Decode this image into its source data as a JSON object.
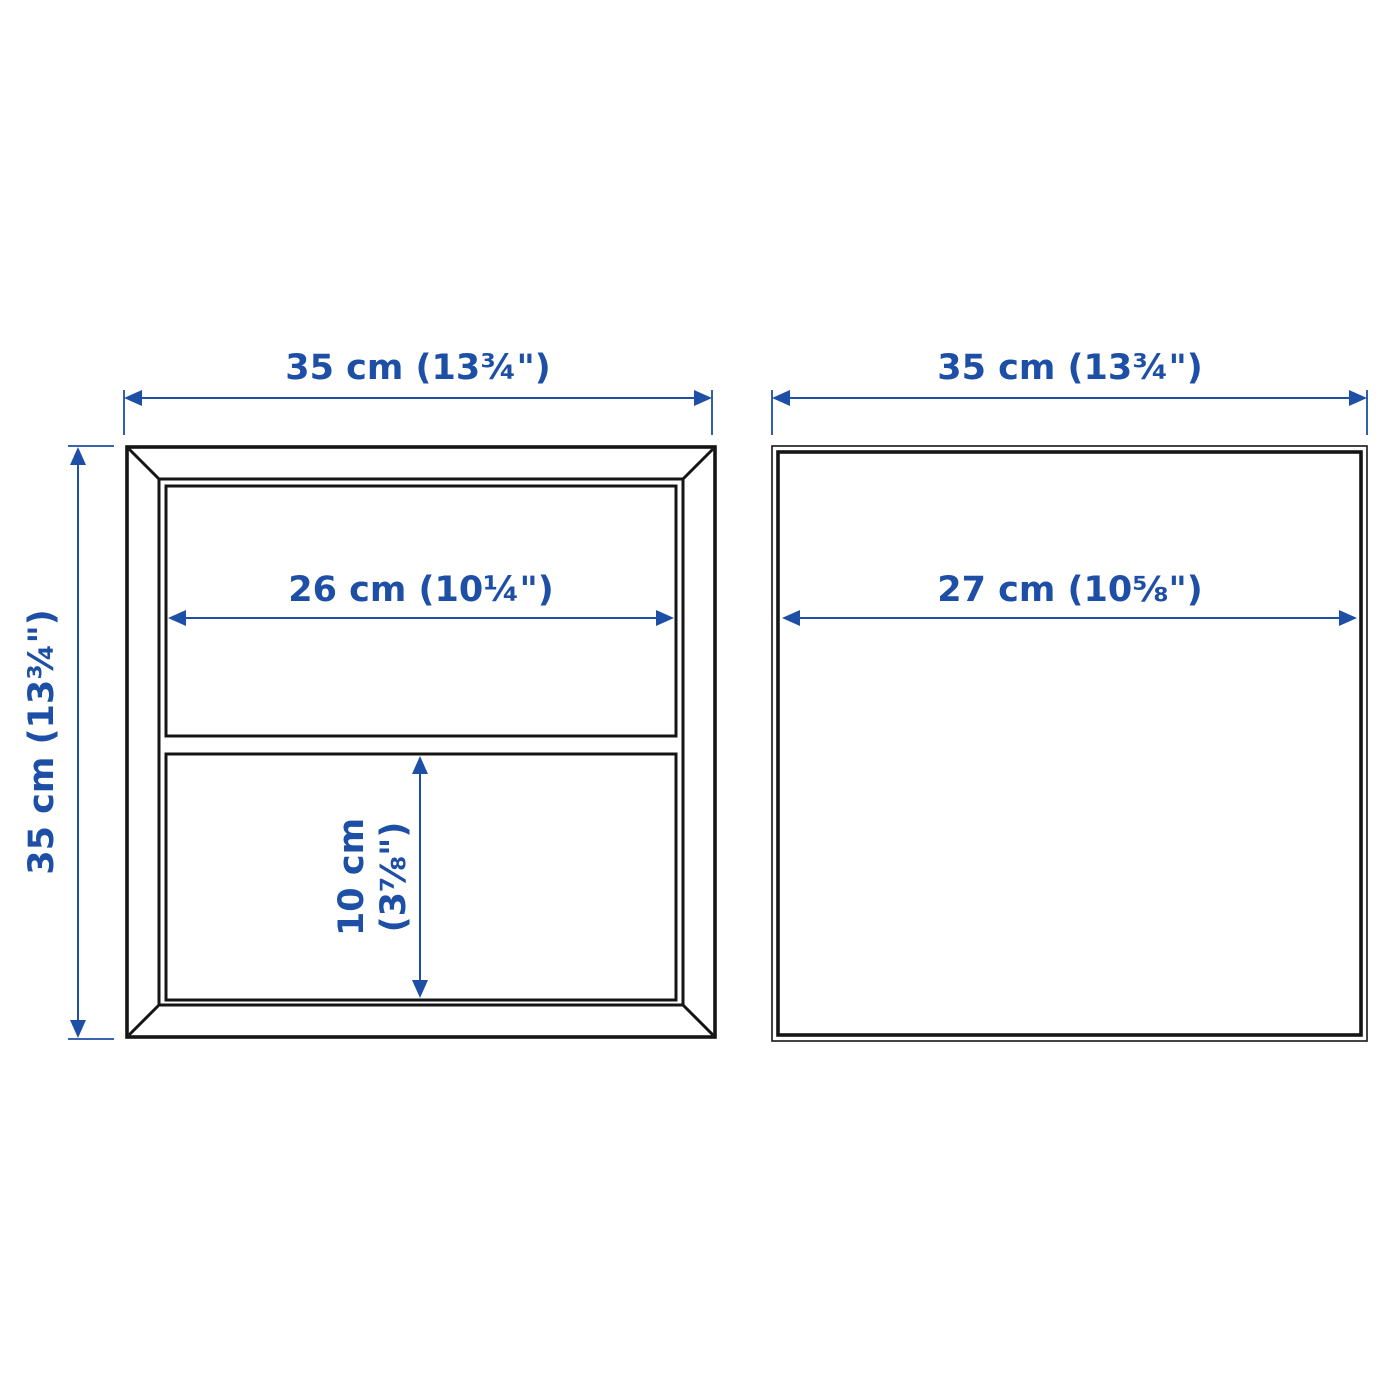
{
  "colors": {
    "dimension": "#1c4fa5",
    "outline": "#151515",
    "background": "#ffffff"
  },
  "front_view": {
    "view_name": "front-view-two-compartments",
    "overall_width_label": "35 cm (13¾\")",
    "overall_height_label": "35 cm (13¾\")",
    "inner_width_label": "26 cm (10¼\")",
    "inner_height_label_line1": "10 cm",
    "inner_height_label_line2": "(3⅞\")"
  },
  "side_view": {
    "view_name": "side-view-square-panel",
    "overall_width_label": "35 cm (13¾\")",
    "inner_depth_label": "27 cm (10⅝\")"
  }
}
